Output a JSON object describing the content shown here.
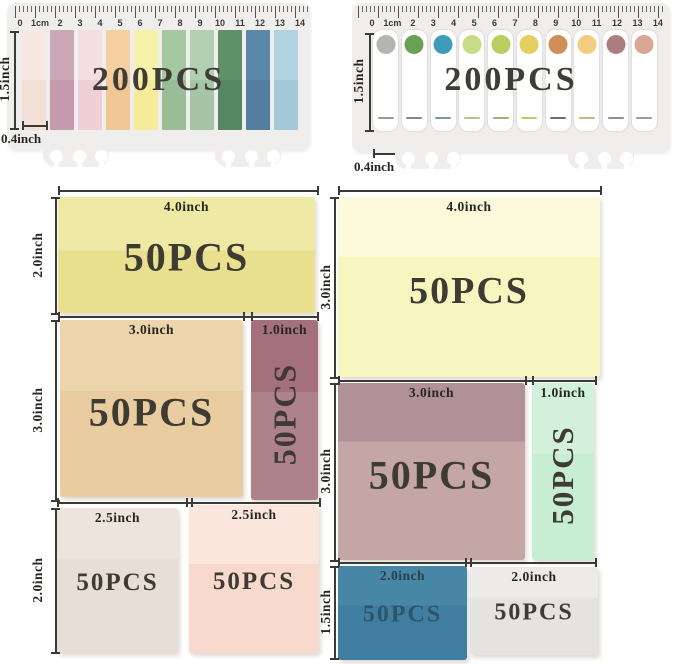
{
  "colors": {
    "page_bg": "#ffffff",
    "card_bg": "#f0eeec",
    "dim_text": "#262622",
    "dim_line": "#3a3a36",
    "pcs_text": "#3e3b33",
    "count_text": "#3f3d35"
  },
  "cards": [
    {
      "count": "200PCS",
      "height_label": "1.5inch",
      "width_label": "0.4inch",
      "ruler_numbers": [
        "0",
        "1cm",
        "2",
        "3",
        "4",
        "5",
        "6",
        "7",
        "8",
        "9",
        "10",
        "11",
        "12",
        "13",
        "14"
      ],
      "strips": [
        {
          "top": "#f6e9e3",
          "bottom": "#f2dfd5"
        },
        {
          "top": "#cba8b6",
          "bottom": "#c59aac"
        },
        {
          "top": "#f3dfe1",
          "bottom": "#eed0d6"
        },
        {
          "top": "#f3cfa1",
          "bottom": "#f0c795"
        },
        {
          "top": "#f7f2a9",
          "bottom": "#f4ec9a"
        },
        {
          "top": "#a4c8a0",
          "bottom": "#99bd96"
        },
        {
          "top": "#b1cfb1",
          "bottom": "#a6c5a7"
        },
        {
          "top": "#5e9168",
          "bottom": "#558760"
        },
        {
          "top": "#5c88a8",
          "bottom": "#537e9e"
        },
        {
          "top": "#b0d2e1",
          "bottom": "#a5c8d8"
        }
      ]
    },
    {
      "count": "200PCS",
      "height_label": "1.5inch",
      "width_label": "0.4inch",
      "ruler_numbers": [
        "0",
        "1cm",
        "2",
        "3",
        "4",
        "5",
        "6",
        "7",
        "8",
        "9",
        "10",
        "11",
        "12",
        "13",
        "14"
      ],
      "tabs": [
        {
          "dot": "#b4b4b0",
          "dash": "#9a9a96"
        },
        {
          "dot": "#6ba153",
          "dash": "#848a7e"
        },
        {
          "dot": "#3e9cba",
          "dash": "#7a96a8"
        },
        {
          "dot": "#c8dc88",
          "dash": "#c2bc8a"
        },
        {
          "dot": "#b9cf62",
          "dash": "#a8ab74"
        },
        {
          "dot": "#e3d05e",
          "dash": "#cfc06a"
        },
        {
          "dot": "#cf8e5a",
          "dash": "#6f6f6b"
        },
        {
          "dot": "#f2cd7f",
          "dash": "#c9b482"
        },
        {
          "dot": "#ab7f80",
          "dash": "#9a8a8a"
        },
        {
          "dot": "#d8a795",
          "dash": "#a89a90"
        }
      ]
    }
  ],
  "notes": [
    {
      "pcs": "50PCS",
      "size": "4.0inch",
      "top": "#eeeaa6",
      "bottom": "#e8e08e"
    },
    {
      "pcs": "50PCS",
      "size": "3.0inch",
      "top": "#ecd5ab",
      "bottom": "#e9cc9f"
    },
    {
      "pcs": "50PCS",
      "size": "1.0inch",
      "top": "#a4707a",
      "bottom": "#ae8289"
    },
    {
      "pcs": "50PCS",
      "size": "2.5inch",
      "top": "#eee4de",
      "bottom": "#e8ded8"
    },
    {
      "pcs": "50PCS",
      "size": "2.5inch",
      "top": "#fbe6dd",
      "bottom": "#f8d9cd"
    },
    {
      "pcs": "50PCS",
      "size": "4.0inch",
      "top": "#fbf9da",
      "bottom": "#f8f6c0"
    },
    {
      "pcs": "50PCS",
      "size": "3.0inch",
      "top": "#b09196",
      "bottom": "#c3a6a5"
    },
    {
      "pcs": "50PCS",
      "size": "1.0inch",
      "top": "#d2f0da",
      "bottom": "#c7edd3"
    },
    {
      "pcs": "50PCS",
      "size": "2.0inch",
      "top": "#4886a6",
      "bottom": "#3f7ea0",
      "text": "#2f5468",
      "label": "#2b3e4a"
    },
    {
      "pcs": "50PCS",
      "size": "2.0inch",
      "top": "#edebe9",
      "bottom": "#e5e3e1"
    }
  ],
  "dims": {
    "vlabels": [
      "2.0inch",
      "3.0inch",
      "2.0inch",
      "3.0inch",
      "3.0inch",
      "1.5inch"
    ]
  }
}
